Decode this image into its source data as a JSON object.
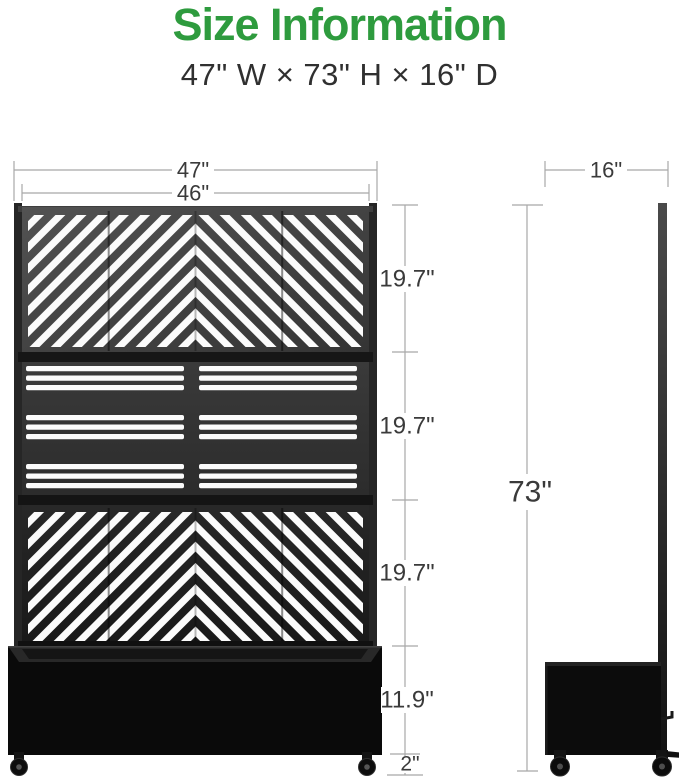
{
  "header": {
    "title": "Size Information",
    "subtitle": "47\" W × 73\" H × 16\" D"
  },
  "front_view": {
    "width_outer_label": "47\"",
    "width_inner_label": "46\"",
    "panel_section_labels": [
      "19.7\"",
      "19.7\"",
      "19.7\""
    ],
    "planter_height_label": "11.9\"",
    "caster_height_label": "2\""
  },
  "side_view": {
    "depth_label": "16\"",
    "overall_height_label": "73\""
  },
  "colors": {
    "accent_green": "#2E9B3E",
    "dimension_line": "#A8A8A8",
    "dimension_text": "#3A3A3A",
    "panel_dark": "#1C1C1C",
    "slat_white": "#FBFBFB"
  }
}
